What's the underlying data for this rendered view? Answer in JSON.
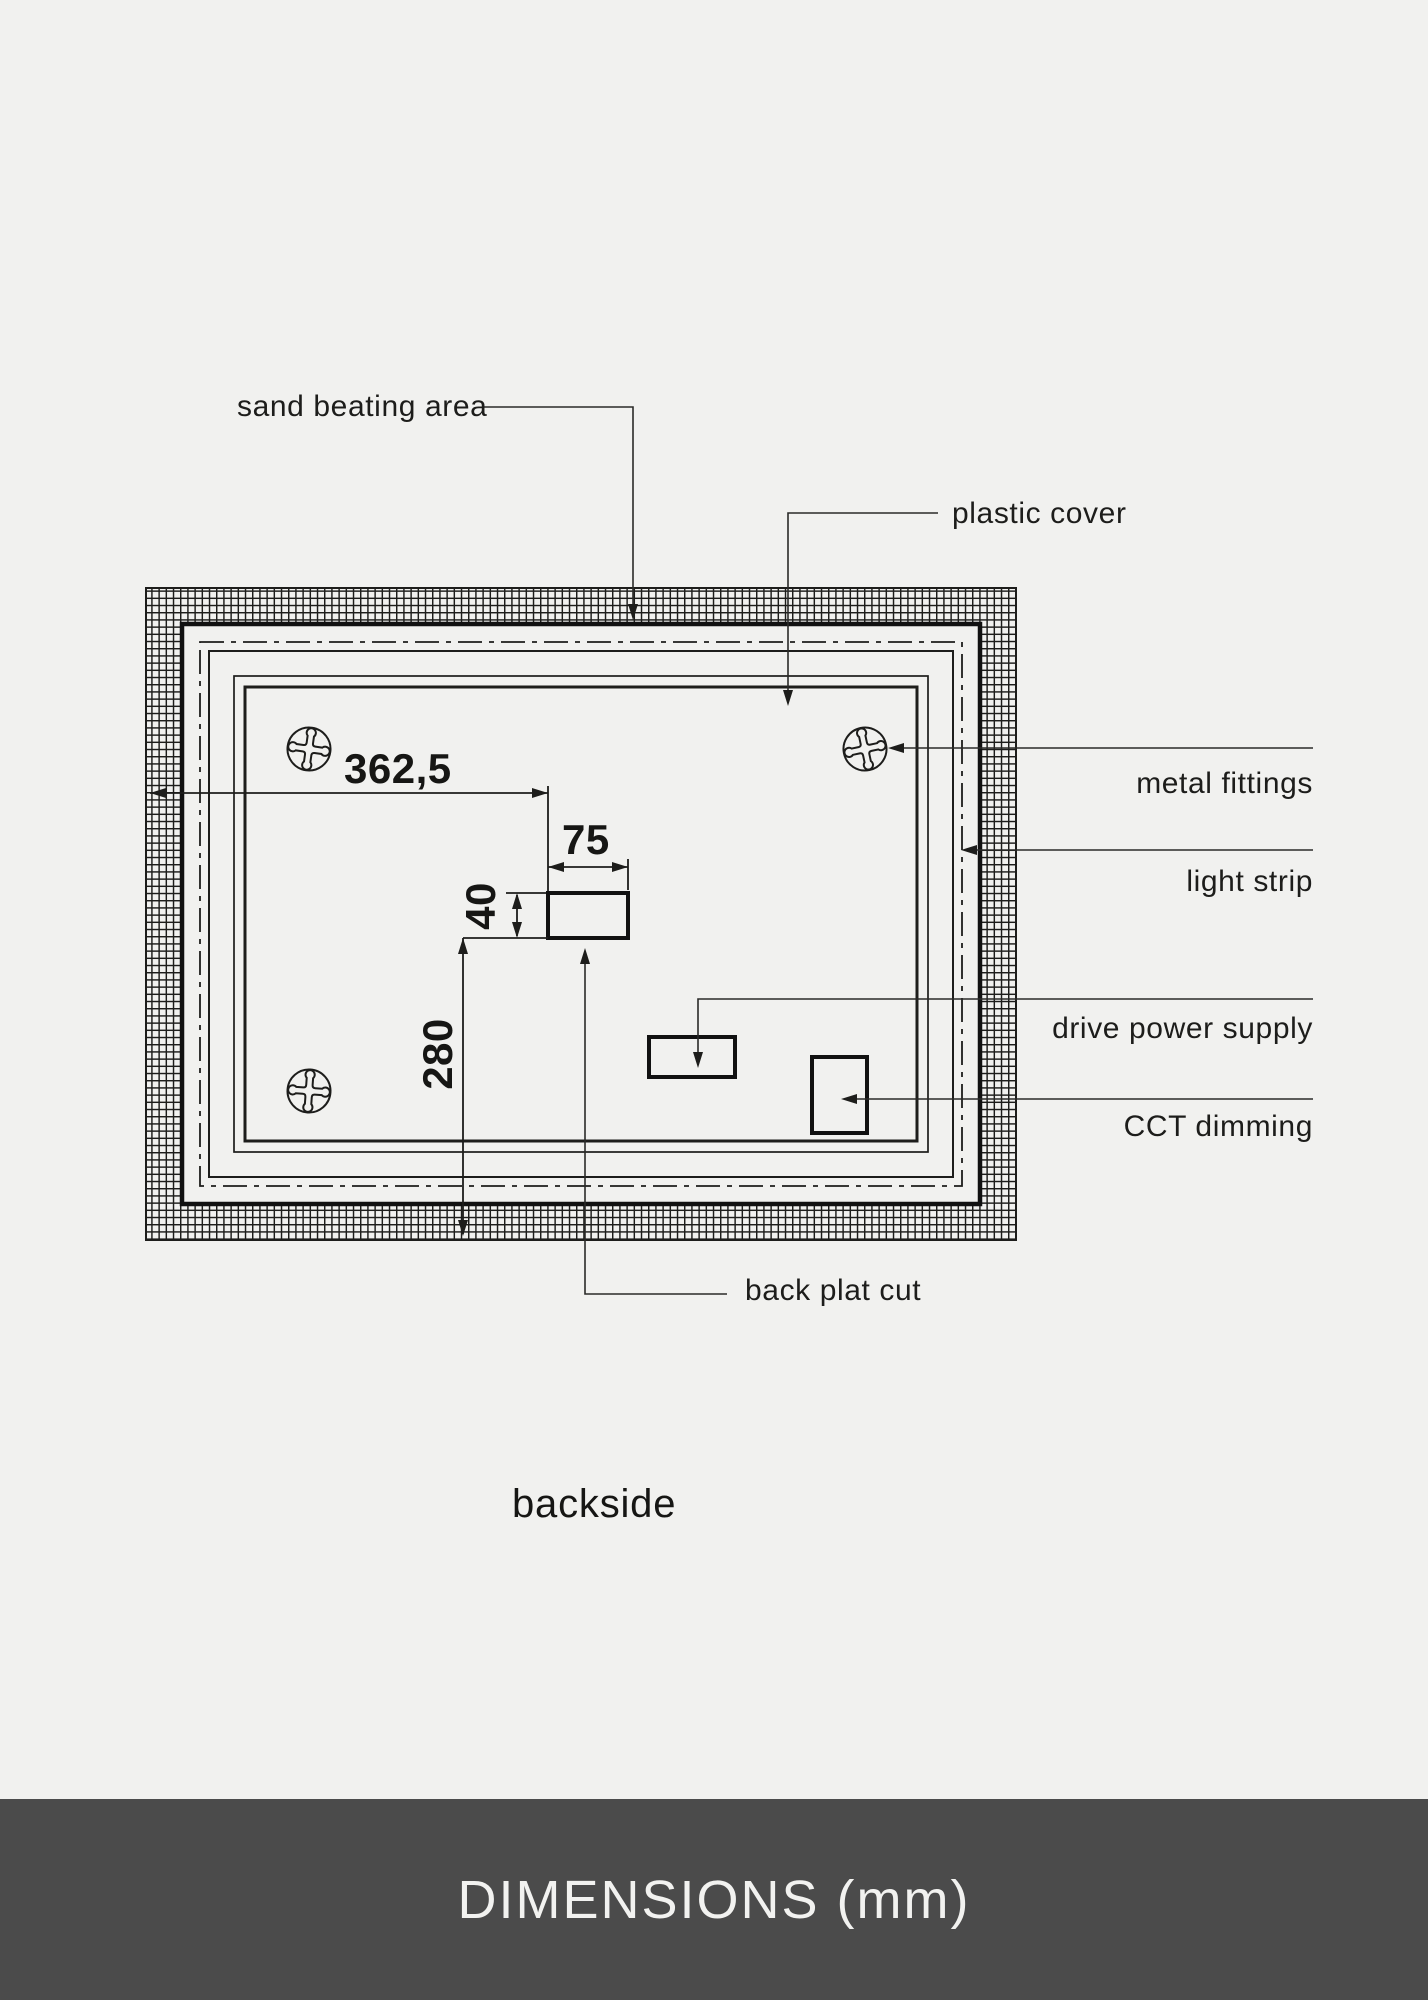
{
  "page": {
    "background_color": "#f1f1ef",
    "line_color": "#1d1d1b"
  },
  "drawing": {
    "caption": "backside",
    "callouts": {
      "sand_beating_area": "sand beating area",
      "plastic_cover": "plastic cover",
      "metal_fittings": "metal fittings",
      "light_strip": "light strip",
      "drive_power_supply": "drive power supply",
      "cct_dimming": "CCT dimming",
      "back_plat_cut": "back plat cut"
    },
    "dimensions": {
      "mount_offset_horizontal": "362,5",
      "cutout_width": "75",
      "cutout_height": "40",
      "cutout_offset_bottom": "280"
    },
    "icons": {
      "screw": "phillips-screw-icon"
    }
  },
  "footer": {
    "title": "DIMENSIONS (mm)",
    "background_color": "#4b4b4b",
    "text_color": "#f2f2f0"
  }
}
